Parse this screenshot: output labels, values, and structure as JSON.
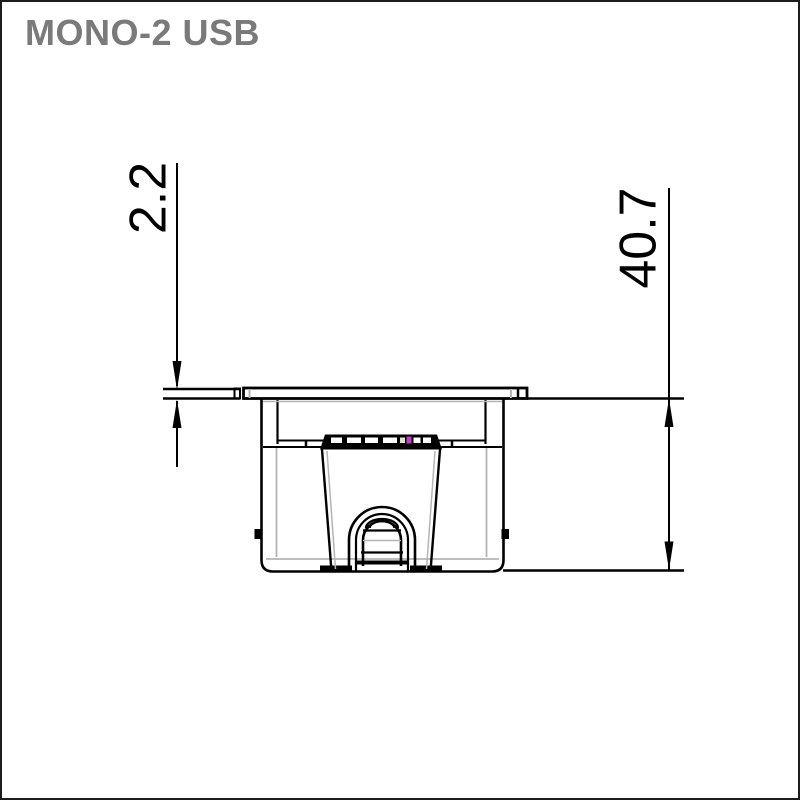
{
  "title": "MONO-2 USB",
  "dimensions": {
    "plate_thickness": {
      "value": "2.2",
      "unit": "mm",
      "placement": "left-vertical"
    },
    "overall_depth": {
      "value": "40.7",
      "unit": "mm",
      "placement": "right-vertical"
    }
  },
  "drawing": {
    "type": "technical-section-view",
    "subject": "recessed USB power unit, side section",
    "colors": {
      "outline": "#000000",
      "secondary_line": "#b4b4b4",
      "title_text": "#7a7a7a",
      "usb_accent": "#c43ecb",
      "usb_accent_secondary": "#e6e4c0",
      "frame_border": "#1c1c1c",
      "background": "#ffffff"
    }
  }
}
